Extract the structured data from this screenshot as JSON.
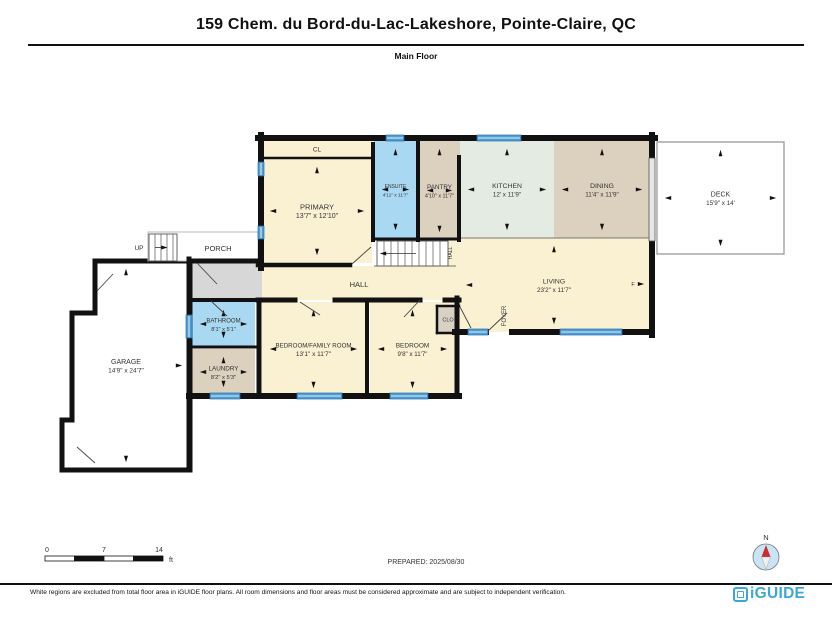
{
  "header": {
    "title": "159 Chem. du Bord-du-Lac-Lakeshore, Pointe-Claire, QC",
    "subtitle": "Main Floor"
  },
  "footer": {
    "disclaimer": "White regions are excluded from total floor area in iGUIDE floor plans. All room dimensions and floor areas must be considered approximate and are subject to independent verification.",
    "brand": "iGUIDE"
  },
  "annotations": {
    "prepared": "PREPARED: 2025/08/30",
    "compass_north": "N",
    "scale": {
      "ticks": [
        "0",
        "7",
        "14"
      ],
      "unit": "ft"
    }
  },
  "colors": {
    "cream": "#FAF0D2",
    "blue": "#A8D8F2",
    "tan": "#DCD0BE",
    "mint": "#E4EBE2",
    "gray": "#D7D7D7",
    "taupe": "#D9D2C4",
    "white": "#FFFFFF",
    "window": "#4E9FD4",
    "windowEdge": "#2B6EA6",
    "wall": "#111111",
    "deckEdge": "#999999",
    "porchEdge": "#B8B8B8",
    "brand": "#3BA7D9",
    "compassFill": "#C9E4F4",
    "needleN": "#CC2B2B",
    "needleS": "#F0F0F0"
  },
  "plan": {
    "rooms": [
      {
        "id": "cl-closet",
        "rect": [
          262,
          141,
          110,
          17
        ],
        "fill": "cream",
        "label": "CL",
        "ls": 6.5,
        "arrows": ""
      },
      {
        "id": "primary",
        "rect": [
          262,
          159,
          110,
          104
        ],
        "fill": "cream",
        "label": "PRIMARY",
        "dims": "13'7\" x 12'10\"",
        "ls": 7.5,
        "ds": 7,
        "arrows": "tblr"
      },
      {
        "id": "ensuite",
        "rect": [
          374,
          141,
          43,
          97
        ],
        "fill": "blue",
        "label": "ENSUITE",
        "dims": "4'11\" x 11'7\"",
        "ls": 5,
        "ds": 4.8,
        "arrows": "tblr"
      },
      {
        "id": "pantry",
        "rect": [
          419,
          141,
          41,
          99
        ],
        "fill": "tan",
        "label": "PANTRY",
        "dims": "4'10\" x 11'7\"",
        "ls": 6.3,
        "ds": 5.4,
        "arrows": "tblr"
      },
      {
        "id": "kitchen",
        "rect": [
          460,
          141,
          94,
          97
        ],
        "fill": "mint",
        "label": "KITCHEN",
        "dims": "12' x 11'9\"",
        "ls": 6.8,
        "ds": 6.3,
        "arrows": "tblr"
      },
      {
        "id": "dining",
        "rect": [
          554,
          141,
          96,
          97
        ],
        "fill": "tan",
        "label": "DINING",
        "dims": "11'4\" x 11'9\"",
        "ls": 6.8,
        "ds": 6.3,
        "arrows": "tblr"
      },
      {
        "id": "hall-fill",
        "rect": [
          262,
          266,
          196,
          34
        ],
        "fill": "cream",
        "arrows": ""
      },
      {
        "id": "landing-fill",
        "rect": [
          448,
          240,
          10,
          26
        ],
        "fill": "cream",
        "arrows": ""
      },
      {
        "id": "living",
        "rect": [
          458,
          238,
          192,
          94
        ],
        "fill": "cream",
        "label": "LIVING",
        "dims": "23'2\" x 11'7\"",
        "ls": 6.8,
        "ds": 6.3,
        "arrows": "tbl"
      },
      {
        "id": "vestibule",
        "rect": [
          192,
          262,
          70,
          38
        ],
        "fill": "gray",
        "arrows": ""
      },
      {
        "id": "bathroom",
        "rect": [
          192,
          302,
          63,
          44
        ],
        "fill": "blue",
        "label": "BATHROOM",
        "dims": "8'1\" x 5'1\"",
        "ls": 6,
        "ds": 5.6,
        "arrows": "tblr"
      },
      {
        "id": "laundry",
        "rect": [
          192,
          349,
          63,
          46
        ],
        "fill": "tan",
        "label": "LAUNDRY",
        "dims": "8'2\" x 5'3\"",
        "ls": 6.3,
        "ds": 5.8,
        "arrows": "tblr"
      },
      {
        "id": "bedroom-family",
        "rect": [
          262,
          302,
          103,
          94
        ],
        "fill": "cream",
        "label": "BEDROOM/FAMILY ROOM",
        "dims": "13'1\" x 11'7\"",
        "ls": 6.2,
        "ds": 6.5,
        "arrows": "tblr"
      },
      {
        "id": "bedroom",
        "rect": [
          370,
          302,
          85,
          94
        ],
        "fill": "cream",
        "label": "BEDROOM",
        "dims": "9'8\" x 11'7\"",
        "ls": 6.5,
        "ds": 6.2,
        "arrows": "tblr"
      },
      {
        "id": "clo-closet",
        "rect": [
          437,
          306,
          22,
          27
        ],
        "fill": "taupe",
        "label": "CLO",
        "ls": 5.5,
        "arrows": ""
      },
      {
        "id": "garage",
        "poly": [
          [
            95,
            261
          ],
          [
            190,
            261
          ],
          [
            190,
            470
          ],
          [
            62,
            470
          ],
          [
            62,
            420
          ],
          [
            72,
            420
          ],
          [
            72,
            313
          ],
          [
            95,
            313
          ]
        ],
        "fill": "white",
        "outline": "wall",
        "ow": 5,
        "label": "GARAGE",
        "dims": "14'9\" x 24'7\"",
        "ls": 7,
        "ds": 6.5,
        "arrows": "tbr"
      },
      {
        "id": "deck",
        "rect": [
          657,
          142,
          127,
          112
        ],
        "fill": "white",
        "outline": "deckEdge",
        "ow": 1.3,
        "label": "DECK",
        "dims": "15'9\" x 14'",
        "ls": 7,
        "ds": 6.3,
        "arrows": "tblr"
      },
      {
        "id": "porch",
        "rect": [
          148,
          232,
          110,
          29
        ],
        "fill": "white",
        "outline": "porchEdge",
        "ow": 1,
        "label": "PORCH",
        "ls": 7.5,
        "lx": 218,
        "ly": 249,
        "arrows": ""
      }
    ],
    "walls": [
      [
        258,
        138,
        655,
        138,
        6
      ],
      [
        261,
        135,
        261,
        268,
        6
      ],
      [
        652,
        135,
        652,
        159,
        6
      ],
      [
        652,
        240,
        652,
        335,
        6
      ],
      [
        258,
        265,
        350,
        265,
        4.5
      ],
      [
        373,
        144,
        373,
        240,
        4
      ],
      [
        418,
        138,
        418,
        240,
        4
      ],
      [
        459,
        157,
        459,
        240,
        4
      ],
      [
        374,
        239,
        459,
        239,
        3
      ],
      [
        262,
        158,
        372,
        158,
        2.5
      ],
      [
        258,
        300,
        295,
        300,
        5
      ],
      [
        335,
        300,
        420,
        300,
        5
      ],
      [
        445,
        300,
        459,
        300,
        5
      ],
      [
        259,
        300,
        259,
        396,
        5
      ],
      [
        189,
        396,
        459,
        396,
        6
      ],
      [
        367,
        302,
        367,
        394,
        4
      ],
      [
        457,
        298,
        457,
        394,
        5
      ],
      [
        455,
        332,
        486,
        332,
        6
      ],
      [
        512,
        332,
        652,
        332,
        6
      ],
      [
        189,
        259,
        189,
        468,
        5
      ],
      [
        189,
        261,
        261,
        261,
        5
      ],
      [
        189,
        300,
        258,
        300,
        4
      ],
      [
        192,
        347,
        255,
        347,
        3
      ],
      [
        437,
        306,
        459,
        306,
        2.5
      ],
      [
        437,
        306,
        437,
        333,
        2.5
      ],
      [
        437,
        333,
        459,
        333,
        2.5
      ]
    ],
    "thin_lines": [
      [
        461,
        238,
        649,
        238
      ],
      [
        374,
        266,
        456,
        266
      ]
    ],
    "windows": [
      [
        386,
        135,
        18,
        6
      ],
      [
        477,
        135,
        44,
        6
      ],
      [
        258,
        162,
        6,
        14
      ],
      [
        258,
        226,
        6,
        13
      ],
      [
        468,
        329,
        20,
        6
      ],
      [
        560,
        329,
        62,
        6
      ],
      [
        297,
        393,
        45,
        6
      ],
      [
        390,
        393,
        38,
        6
      ],
      [
        210,
        393,
        30,
        6
      ],
      [
        186,
        315,
        6,
        23
      ]
    ],
    "patio_door": [
      649,
      158,
      6,
      83
    ],
    "doors": [
      [
        352,
        264,
        371,
        247
      ],
      [
        404,
        317,
        420,
        300
      ],
      [
        300,
        302,
        320,
        315
      ],
      [
        488,
        331,
        507,
        313
      ],
      [
        460,
        307,
        471,
        328
      ],
      [
        197,
        263,
        217,
        284
      ],
      [
        211,
        301,
        227,
        316
      ],
      [
        97,
        291,
        113,
        274
      ],
      [
        77,
        447,
        95,
        463
      ]
    ],
    "stairs": [
      {
        "x": 377,
        "y": 241,
        "w": 71,
        "h": 25,
        "step": 7,
        "dir": "l"
      },
      {
        "x": 149,
        "y": 234,
        "w": 28,
        "h": 27,
        "step": 6,
        "dir": "r"
      }
    ],
    "marks": [
      {
        "x": 641,
        "y": 284,
        "d": "r"
      }
    ],
    "extra_labels": [
      {
        "text": "HALL",
        "x": 359,
        "y": 287,
        "size": 7.5
      },
      {
        "text": "HALL",
        "x": 452,
        "y": 253,
        "size": 5,
        "rot": -90
      },
      {
        "text": "FOYER",
        "x": 506,
        "y": 316,
        "size": 6,
        "rot": -90
      },
      {
        "text": "UP",
        "x": 139,
        "y": 250,
        "size": 6.5
      },
      {
        "text": "F",
        "x": 633,
        "y": 286,
        "size": 5.5
      }
    ],
    "scale_bar": {
      "x": 45,
      "y": 556,
      "len": 118,
      "h": 5,
      "segments": 4
    },
    "compass": {
      "cx": 766,
      "cy": 557,
      "r": 13
    },
    "prepared_pos": [
      426,
      564
    ]
  }
}
